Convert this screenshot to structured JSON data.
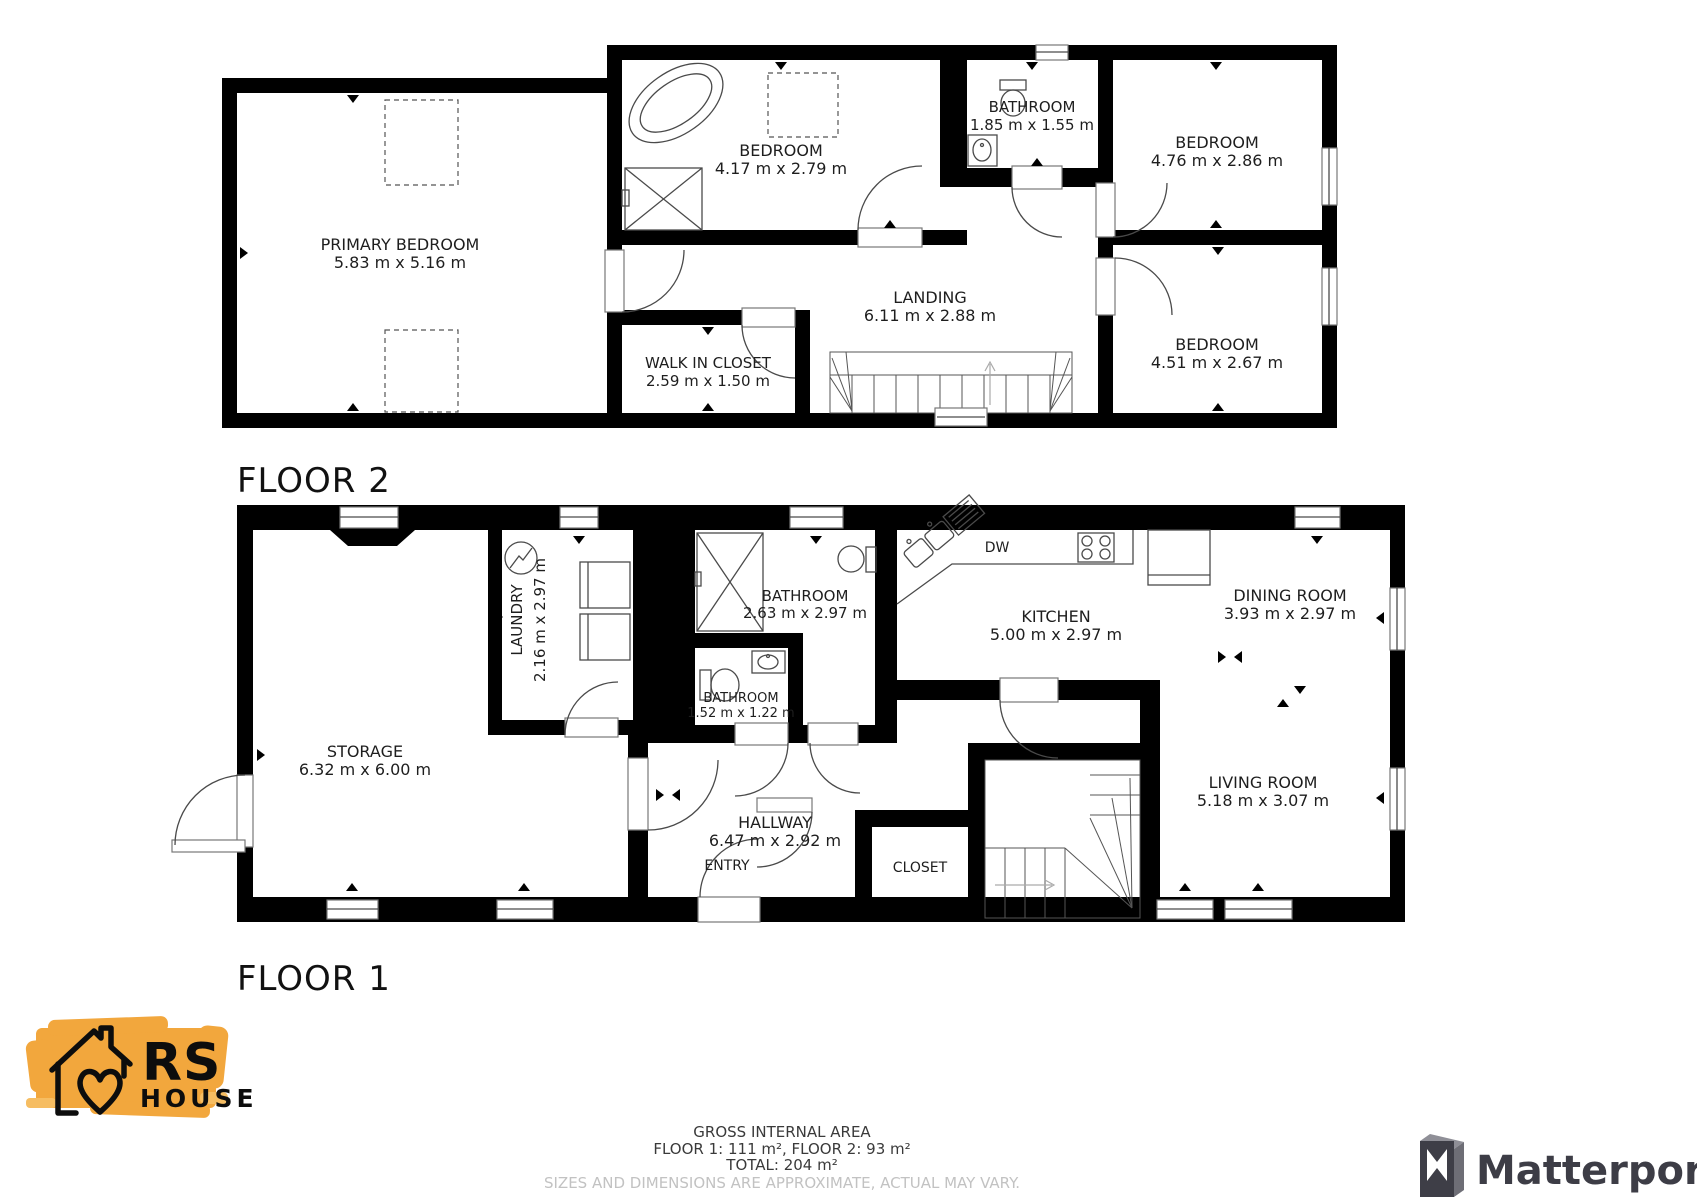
{
  "floor2": {
    "title": "FLOOR 2",
    "rooms": [
      {
        "name": "PRIMARY BEDROOM",
        "dims": "5.83 m x 5.16 m"
      },
      {
        "name": "BEDROOM",
        "dims": "4.17 m x 2.79 m"
      },
      {
        "name": "BATHROOM",
        "dims": "1.85 m x 1.55 m"
      },
      {
        "name": "BEDROOM",
        "dims": "4.76 m x 2.86 m"
      },
      {
        "name": "LANDING",
        "dims": "6.11 m x 2.88 m"
      },
      {
        "name": "WALK IN CLOSET",
        "dims": "2.59 m x 1.50 m"
      },
      {
        "name": "BEDROOM",
        "dims": "4.51 m x 2.67 m"
      }
    ]
  },
  "floor1": {
    "title": "FLOOR 1",
    "rooms": [
      {
        "name": "STORAGE",
        "dims": "6.32 m x 6.00 m"
      },
      {
        "name": "LAUNDRY",
        "dims": "2.16 m x 2.97 m"
      },
      {
        "name": "BATHROOM",
        "dims": "2.63 m x 2.97 m"
      },
      {
        "name": "BATHROOM",
        "dims": "1.52 m x 1.22 m"
      },
      {
        "name": "KITCHEN",
        "dims": "5.00 m x 2.97 m"
      },
      {
        "name": "DINING ROOM",
        "dims": "3.93 m x 2.97 m"
      },
      {
        "name": "HALLWAY",
        "dims": "6.47 m x 2.92 m"
      },
      {
        "name": "LIVING ROOM",
        "dims": "5.18 m x 3.07 m"
      },
      {
        "name": "ENTRY",
        "dims": ""
      },
      {
        "name": "CLOSET",
        "dims": ""
      }
    ],
    "labels": {
      "dishwasher": "DW"
    }
  },
  "footer": {
    "line1": "GROSS INTERNAL AREA",
    "line2": "FLOOR 1: 111 m², FLOOR 2: 93 m²",
    "line3": "TOTAL: 204 m²",
    "disclaimer": "SIZES AND DIMENSIONS ARE APPROXIMATE, ACTUAL MAY VARY."
  },
  "branding": {
    "rs_logo": {
      "line1": "RS",
      "line2": "HOUSE",
      "brush_color": "#F2A73D"
    },
    "matterport": {
      "text": "Matterport"
    }
  }
}
